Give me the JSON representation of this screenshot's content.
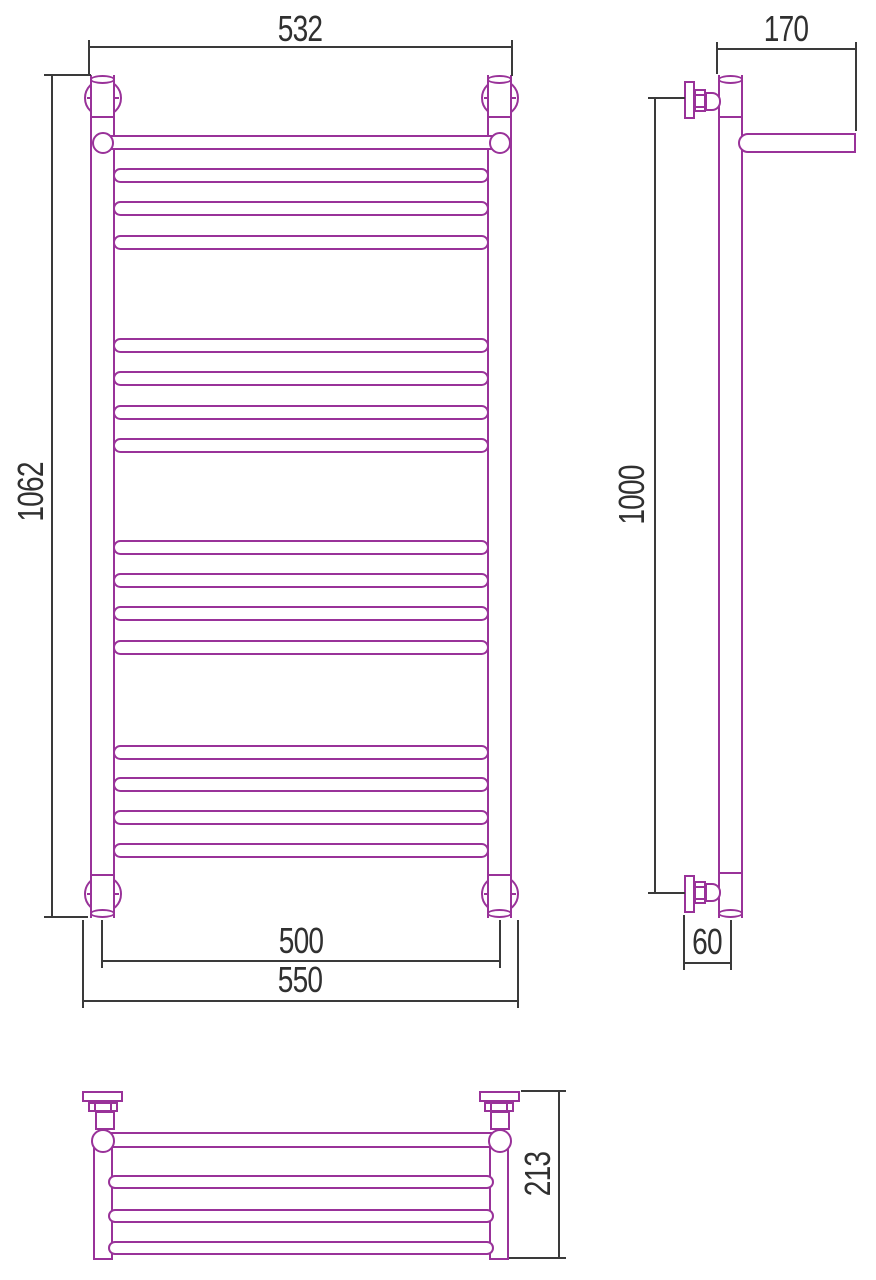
{
  "drawing": {
    "colors": {
      "part": "#993299",
      "dimension": "#3a3a3a"
    },
    "front": {
      "width_top": "532",
      "height": "1062",
      "inner_width": "500",
      "outer_width": "550"
    },
    "side": {
      "depth": "170",
      "height": "1000",
      "axis_offset": "60"
    },
    "plan": {
      "depth": "213"
    }
  }
}
